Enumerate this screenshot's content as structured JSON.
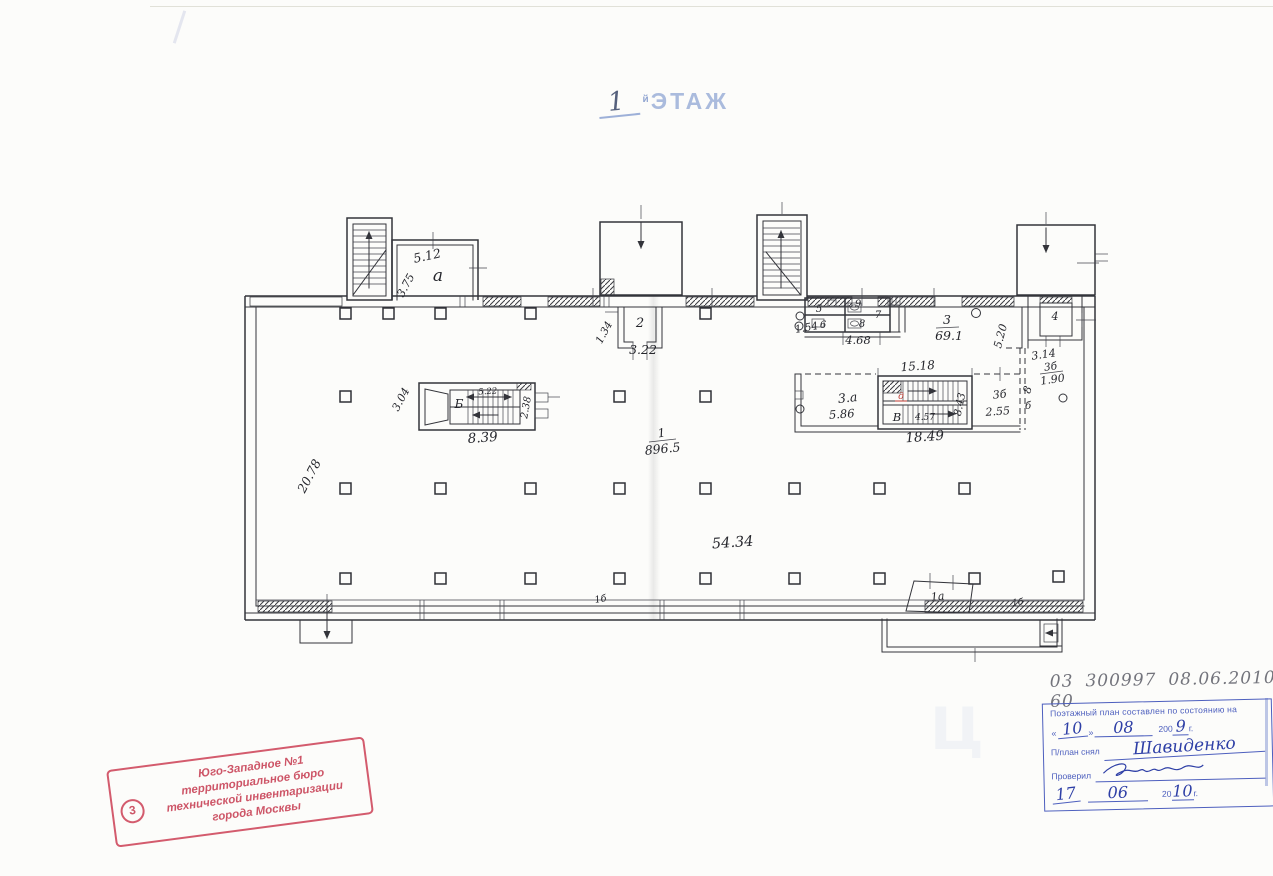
{
  "document": {
    "title": {
      "number": "1",
      "suffix": "й",
      "word": "ЭТАЖ"
    },
    "pencil_note": {
      "code": "03 60",
      "code2": "300997",
      "date": "08.06.2010"
    },
    "survey_stamp": {
      "header": "Поэтажный план составлен по состоянию на",
      "quote_open": "«",
      "quote_close": "»",
      "day": "10",
      "month": "08",
      "year_printed": "200",
      "year_hand": "9",
      "year_suffix": "г.",
      "plan_by_label": "П/план снял",
      "plan_by_name": "Шавиденко",
      "checked_label": "Проверил",
      "date2_day": "17",
      "date2_month": "06",
      "date2_year_printed": "20",
      "date2_year_hand": "10",
      "date2_suffix": "г."
    },
    "bti_stamp": {
      "number": "3",
      "lines": [
        "Юго-Западное №1",
        "территориальное бюро",
        "технической инвентаризации",
        "города Москвы"
      ]
    }
  },
  "plan": {
    "labels": {
      "room_a": "а",
      "dim_a_w": "5.12",
      "dim_a_h": "3.75",
      "room_2": "2",
      "dim_2": "3.22",
      "dim_2_side": "1.34",
      "dim_154": "1.54",
      "room_5": "5",
      "room_6": "6",
      "room_7": "7",
      "room_8": "8",
      "room_9": "9",
      "dim_468": "4.68",
      "room_3_num": "3",
      "room_3_area": "69.1",
      "dim_520": "5.20",
      "dim_1518": "15.18",
      "dim_314": "3.14",
      "room_3b_num": "3б",
      "room_3b_area": "1.90",
      "room_3a": "3.а",
      "dim_586": "5.86",
      "stair_v": "В",
      "red_mark": "д",
      "dim_843": "8.43",
      "dim_457": "4.57",
      "dim_1849": "18.49",
      "room_3b2": "3б",
      "dim_255": "2.55",
      "dim_8": "8",
      "dim_b": "б",
      "room_4": "4",
      "stair_b": "Б",
      "dim_522": "5.22",
      "dim_238": "2.38",
      "dim_839": "8.39",
      "dim_304": "3.04",
      "room_1_num": "1",
      "room_1_area": "896.5",
      "dim_5434": "54.34",
      "dim_2078": "20.78",
      "room_1a": "1а",
      "room_1b_right": "1б",
      "room_1b_center": "1б"
    }
  }
}
